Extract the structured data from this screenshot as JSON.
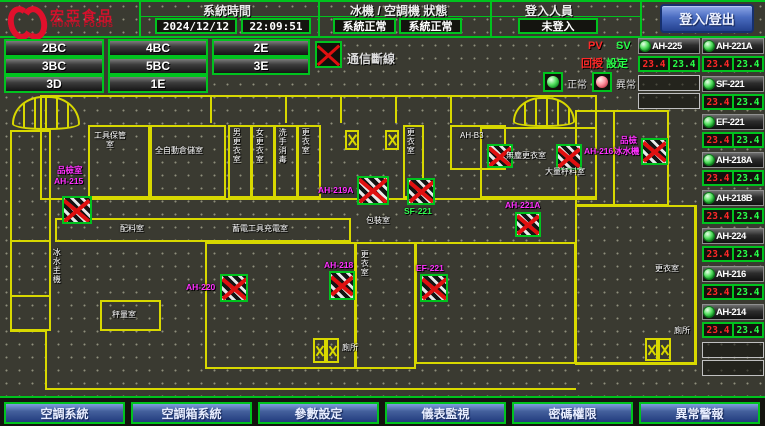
{
  "colors": {
    "accent_green": "#00c31e",
    "wall_yellow": "#d8d800",
    "pv_red": "#ff2828",
    "sv_green": "#28ff48",
    "device_magenta": "#ff30ff",
    "button_blue": "#24418f",
    "brand_red": "#d6102c"
  },
  "header": {
    "logo_text": "宏亞食品",
    "logo_sub": "HUNYA FOODS",
    "system_time_label": "系統時間",
    "date": "2024/12/12",
    "time": "22:09:51",
    "status_label": "冰機 / 空調機 狀態",
    "chiller_status": "系統正常",
    "ac_status": "系統正常",
    "login_label": "登入人員",
    "login_value": "未登入",
    "login_button": "登入/登出"
  },
  "floor_buttons": [
    {
      "label": "2BC"
    },
    {
      "label": "4BC"
    },
    {
      "label": "2E"
    },
    {
      "label": "3BC"
    },
    {
      "label": "5BC"
    },
    {
      "label": "3E"
    },
    {
      "label": "3D"
    },
    {
      "label": "1E"
    }
  ],
  "legend": {
    "comm_loss": "通信斷線",
    "normal": "正常",
    "abnormal": "異常",
    "pv": "PV",
    "sv": "SV",
    "pv_cn": "回授",
    "sv_cn": "設定"
  },
  "panel": {
    "left": [
      {
        "name": "AH-225",
        "pv": "23.4",
        "sv": "23.4",
        "status": "normal"
      }
    ],
    "right": [
      {
        "name": "AH-221A",
        "pv": "23.4",
        "sv": "23.4",
        "status": "normal"
      },
      {
        "name": "SF-221",
        "pv": "23.4",
        "sv": "23.4",
        "status": "normal"
      },
      {
        "name": "EF-221",
        "pv": "23.4",
        "sv": "23.4",
        "status": "normal"
      },
      {
        "name": "AH-218A",
        "pv": "23.4",
        "sv": "23.4",
        "status": "normal"
      },
      {
        "name": "AH-218B",
        "pv": "23.4",
        "sv": "23.4",
        "status": "normal"
      },
      {
        "name": "AH-224",
        "pv": "23.4",
        "sv": "23.4",
        "status": "normal"
      },
      {
        "name": "AH-216",
        "pv": "23.4",
        "sv": "23.4",
        "status": "normal"
      },
      {
        "name": "AH-214",
        "pv": "23.4",
        "sv": "23.4",
        "status": "normal"
      }
    ]
  },
  "map": {
    "labels": [
      {
        "text": "工具保管室"
      },
      {
        "text": "全自動倉儲室"
      },
      {
        "text": "男更衣室"
      },
      {
        "text": "女更衣室"
      },
      {
        "text": "洗手消毒"
      },
      {
        "text": "更衣室"
      },
      {
        "text": "更衣室"
      },
      {
        "text": "AH-B3"
      },
      {
        "text": "無塵更衣室"
      },
      {
        "text": "大量秤料室"
      },
      {
        "text": "蓄電工具充電室"
      },
      {
        "text": "配料室"
      },
      {
        "text": "包裝室"
      },
      {
        "text": "更衣室"
      },
      {
        "text": "秤量室"
      },
      {
        "text": "冰水主機"
      },
      {
        "text": "更衣室"
      },
      {
        "text": "廁所"
      },
      {
        "text": "廁所"
      },
      {
        "text": "品檢室"
      },
      {
        "text": "AH-215"
      },
      {
        "text": "AH-220"
      },
      {
        "text": "AH-218"
      },
      {
        "text": "AH-219A"
      },
      {
        "text": "SF-221"
      },
      {
        "text": "EF-221"
      },
      {
        "text": "AH-216"
      },
      {
        "text": "品檢"
      },
      {
        "text": "冰水機"
      },
      {
        "text": "AH-221A"
      }
    ]
  },
  "footer_buttons": [
    {
      "label": "空調系統"
    },
    {
      "label": "空調箱系統"
    },
    {
      "label": "參數設定"
    },
    {
      "label": "儀表監視"
    },
    {
      "label": "密碼權限"
    },
    {
      "label": "異常警報"
    }
  ]
}
